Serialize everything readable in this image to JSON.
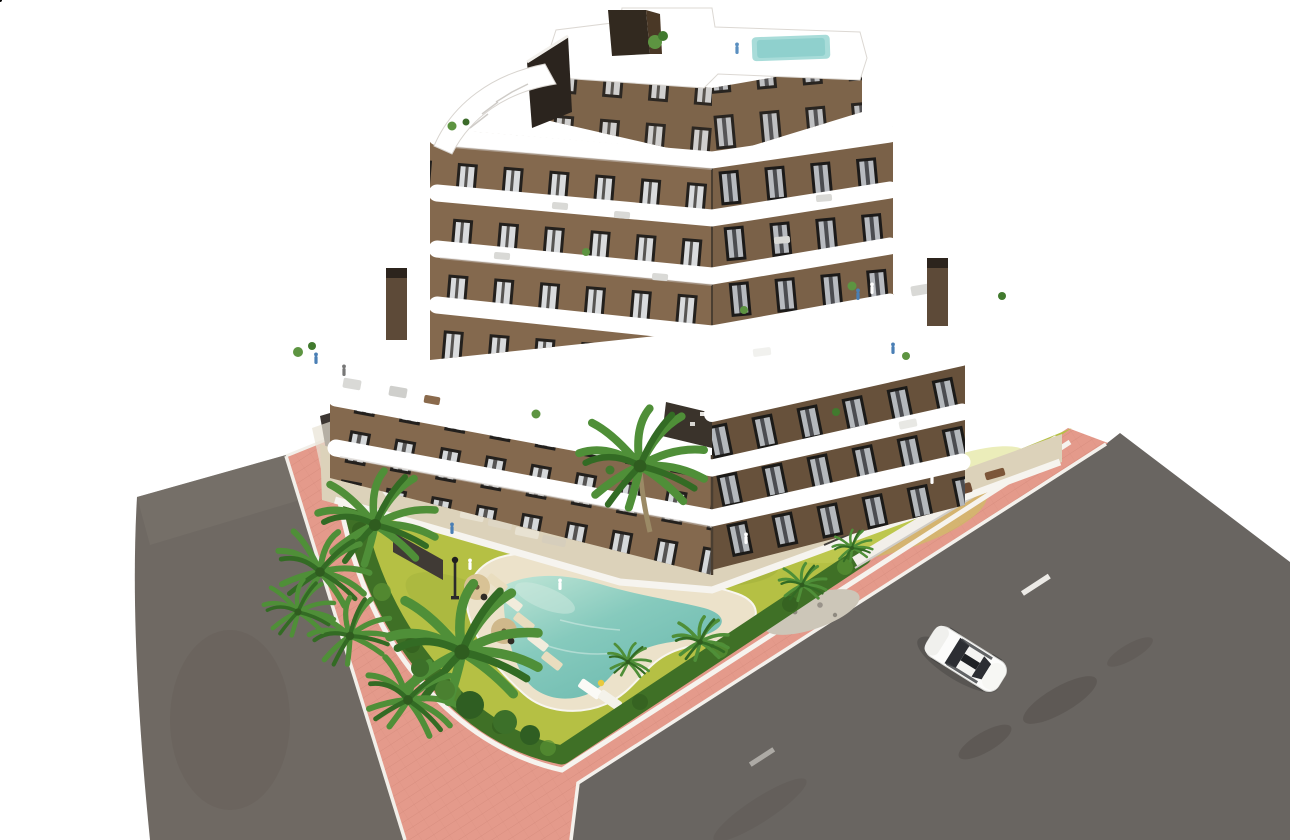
{
  "scene": {
    "title": "Aerial 3D architectural rendering of a modern apartment building with curved white balconies, rooftop terraces, landscaped garden with free-form pool, palm trees, pink pavement and asphalt roads with one white car",
    "background": "#ffffff"
  },
  "palette": {
    "facade_light": "#84694e",
    "facade_dark": "#6f5840",
    "penthouse": "#7d644a",
    "band_white": "#ffffff",
    "lawn": "#b5c044",
    "hedge": "#3f7026",
    "palm_green": "#4f8f38",
    "pool_deck": "#ece2ca",
    "sidewalk_pink": "#e49a8b",
    "road_left": "#6f6963",
    "road_right": "#696561",
    "courtyard_tile": "#dcd2ba",
    "car_body": "#fcfcfb",
    "roof_pool": "#a8dcd9",
    "chimney": "#5d4a38",
    "dark_glass": "#2b241e"
  },
  "objects": {
    "building": "apartment building",
    "rooftop_pool": "rooftop plunge pool",
    "stair_ramp": "rooftop access stair",
    "left_road": "asphalt road left",
    "right_road": "asphalt road right",
    "sidewalk": "pink paved sidewalk",
    "garden": "landscaped garden lawn",
    "hedge": "perimeter hedge",
    "pool": "free-form swimming pool",
    "car": "white car",
    "palm": "palm tree",
    "lamp": "garden lamp post"
  }
}
